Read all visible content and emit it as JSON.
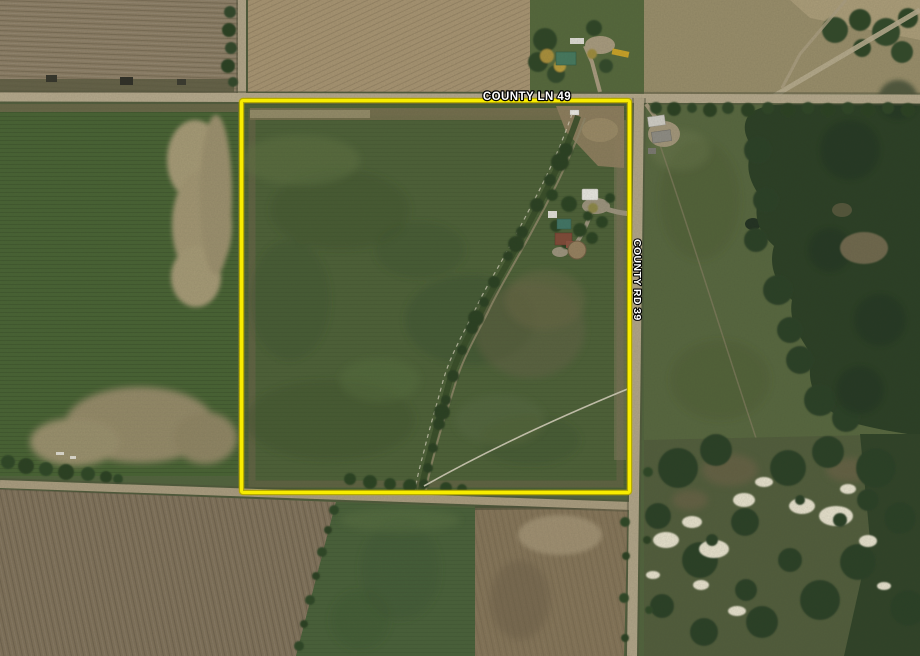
{
  "map": {
    "type": "aerial-satellite-view",
    "road_labels": [
      {
        "text": "COUNTY LN 49",
        "orientation": "horizontal"
      },
      {
        "text": "COUNTY RD 39",
        "orientation": "vertical"
      }
    ],
    "parcel_overlay": {
      "shape": "rectangle",
      "stroke_color": "#f8ec00",
      "stroke_edge_color": "#b7ab00"
    },
    "label_text_color": "#ffffff",
    "label_outline_color": "#000000"
  }
}
